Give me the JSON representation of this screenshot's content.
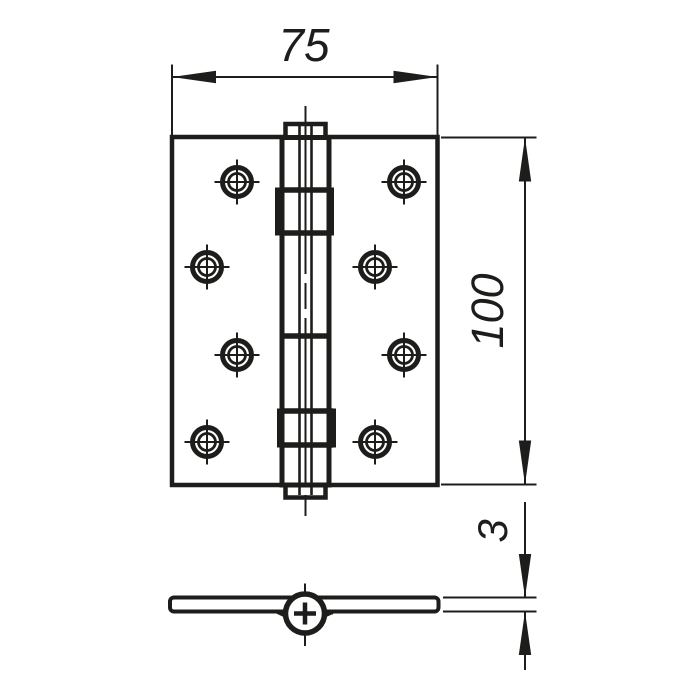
{
  "page": {
    "background_color": "#ffffff",
    "line_color": "#1d1d1b"
  },
  "drawing": {
    "type": "technical-drawing",
    "subject": "door-hinge",
    "front_view": {
      "screw_hole_count": 8
    },
    "dimensions": {
      "width": {
        "value": "75"
      },
      "height": {
        "value": "100"
      },
      "thickness": {
        "value": "3"
      }
    }
  }
}
